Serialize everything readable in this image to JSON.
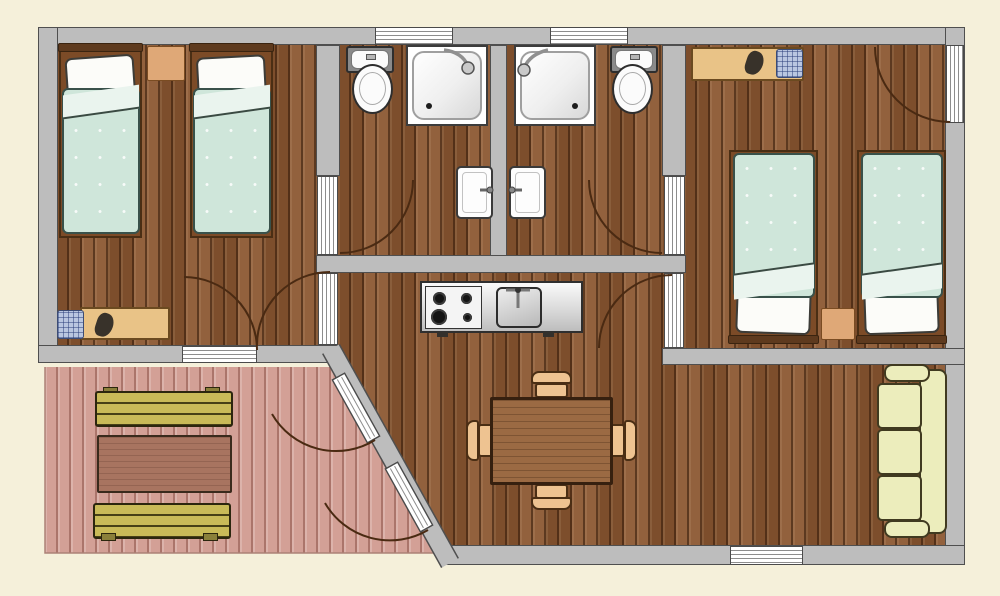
{
  "canvas": {
    "width": 1000,
    "height": 596
  },
  "palette": {
    "background": "#f5f0da",
    "wall_fill": "#bdbdbd",
    "wall_outline": "#4f4f4f",
    "wood_floor": "#8b5731",
    "deck_floor": "#d3a096",
    "arc_line": "#4a2a12",
    "blanket": "#cfe6da",
    "blanket_fold": "#eaf4ee",
    "pillow": "#fcfcf9",
    "bed_frame": "#7c4b27",
    "headboard": "#5e3a1e",
    "desk_tan": "#e9c387",
    "nightstand_tan": "#dfa877",
    "chair_tan": "#eec391",
    "chair_blue": "#b9c6e0",
    "dining_table": "#9b6a43",
    "deck_table": "#a87460",
    "bench_olive": "#c9ba58",
    "sofa_cream": "#ecedbc"
  },
  "rooms": {
    "bedroom_left": {
      "label": "Left bedroom: two single beds, nightstand, desk with chairs, doors to bathroom, living room and deck"
    },
    "bathroom_left": {
      "label": "Left bathroom: toilet, shower, washbasin, window"
    },
    "bathroom_right": {
      "label": "Right bathroom: shower, toilet, washbasin, window"
    },
    "bedroom_right": {
      "label": "Right bedroom: desk with chairs, two single beds, nightstand, exterior door"
    },
    "living": {
      "label": "Living room / kitchen: kitchenette with stove and sink, dining table with four chairs, three-seat sofa"
    },
    "deck": {
      "label": "Deck: two garden benches and garden table, French doors to living room"
    }
  },
  "elements": {
    "doors": [
      "bathroom-left-door",
      "bathroom-right-door",
      "bedroom-left-living-door",
      "bedroom-left-deck-door",
      "bedroom-right-living-door",
      "bedroom-right-exterior-door",
      "french-door-upper",
      "french-door-lower"
    ],
    "windows": [
      "bathroom-left-window",
      "bathroom-right-window",
      "living-room-window"
    ],
    "kitchen": [
      "four-burner-stove",
      "steel-counter",
      "kitchen-sink",
      "faucet"
    ],
    "furniture": [
      "single-bed (x4)",
      "nightstand (x2)",
      "desk (x2)",
      "woven-chair (x2)",
      "stool (x2)",
      "dining-table",
      "dining-chair (x4)",
      "three-seat-sofa",
      "garden-bench (x2)",
      "garden-table",
      "toilet (x2)",
      "shower (x2)",
      "washbasin (x2)"
    ]
  }
}
